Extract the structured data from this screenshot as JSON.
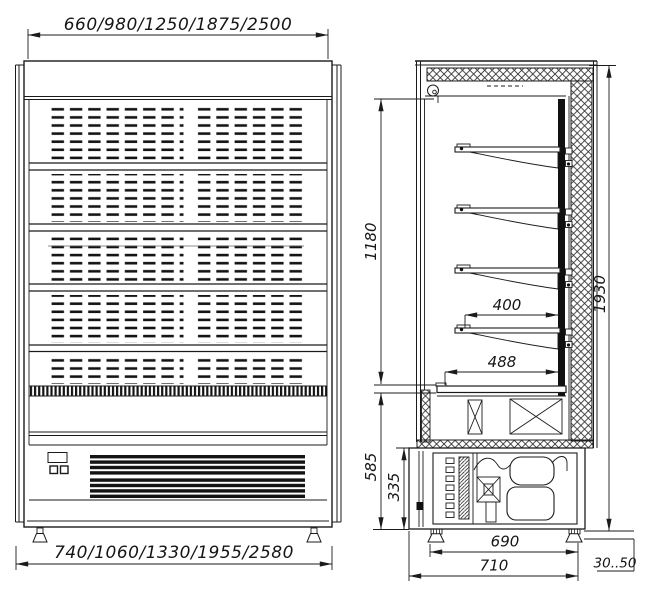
{
  "front_view": {
    "top_width_label": "660/980/1250/1875/2500",
    "bottom_width_label": "740/1060/1330/1955/2580"
  },
  "side_view": {
    "inner_height_label": "1180",
    "shelf_depth_label": "400",
    "deck_depth_label": "488",
    "base_section_height_label": "585",
    "machine_compartment_height_label": "335",
    "overall_height_label": "1930",
    "base_width_label": "690",
    "overall_depth_label": "710",
    "leg_adjustment_label": "30..50"
  }
}
